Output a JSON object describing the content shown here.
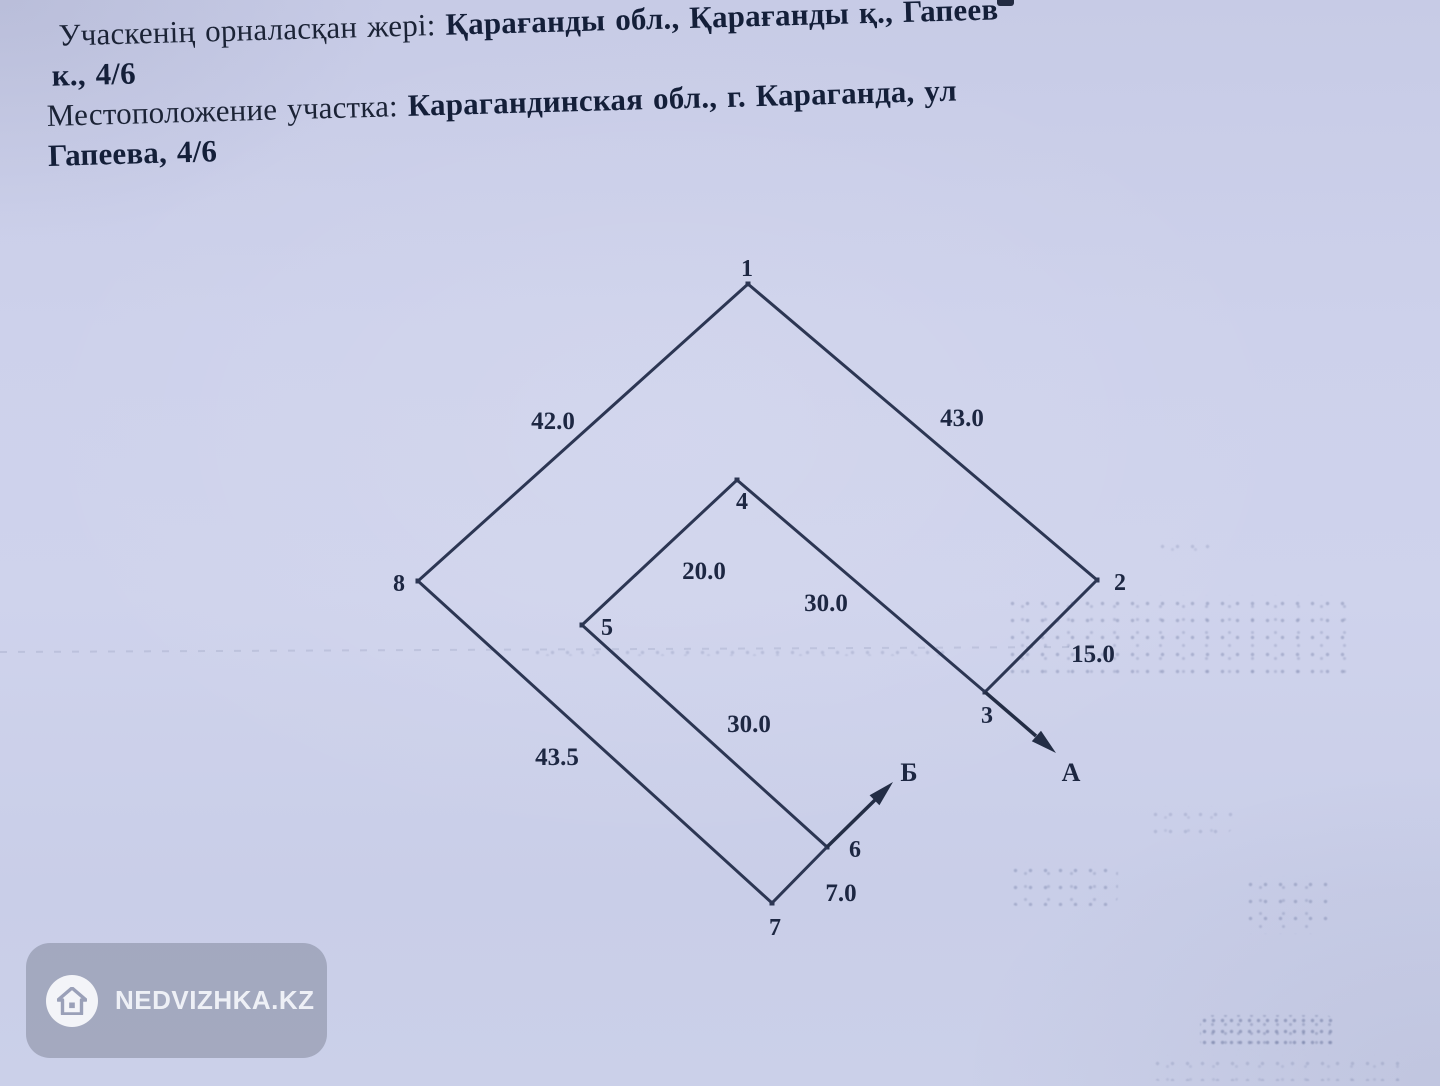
{
  "document": {
    "location_kk": {
      "label": "Учаскенің орналасқан жері: ",
      "value": "Қарағанды обл., Қарағанды қ., Гапеев",
      "value_wrap": "к., 4/6"
    },
    "location_ru": {
      "label": "Местоположение участка: ",
      "value": "Карагандинская обл., г. Караганда, ул",
      "value_wrap": "Гапеева, 4/6"
    }
  },
  "diagram": {
    "type": "land-parcel-plan",
    "points": [
      {
        "label": "1"
      },
      {
        "label": "2"
      },
      {
        "label": "3"
      },
      {
        "label": "4"
      },
      {
        "label": "5"
      },
      {
        "label": "6"
      },
      {
        "label": "7"
      },
      {
        "label": "8"
      }
    ],
    "edges": [
      {
        "from": "1",
        "to": "2",
        "length": "43.0"
      },
      {
        "from": "2",
        "to": "3",
        "length": "15.0"
      },
      {
        "from": "3",
        "to": "4",
        "length": "30.0"
      },
      {
        "from": "4",
        "to": "5",
        "length": "20.0"
      },
      {
        "from": "5",
        "to": "6",
        "length": "30.0"
      },
      {
        "from": "6",
        "to": "7",
        "length": "7.0"
      },
      {
        "from": "7",
        "to": "8",
        "length": "43.5"
      },
      {
        "from": "8",
        "to": "1",
        "length": "42.0"
      }
    ],
    "directions": [
      {
        "label": "А"
      },
      {
        "label": "Б"
      }
    ]
  },
  "watermark": {
    "text": "NEDVIZHKA.KZ",
    "icon": "house-icon"
  },
  "colors": {
    "paper": "#cdd1eb",
    "ink": "#2c3653",
    "text": "#1b2336",
    "watermark_pill": "rgba(148,154,175,0.72)",
    "watermark_text": "#eef0f6"
  }
}
